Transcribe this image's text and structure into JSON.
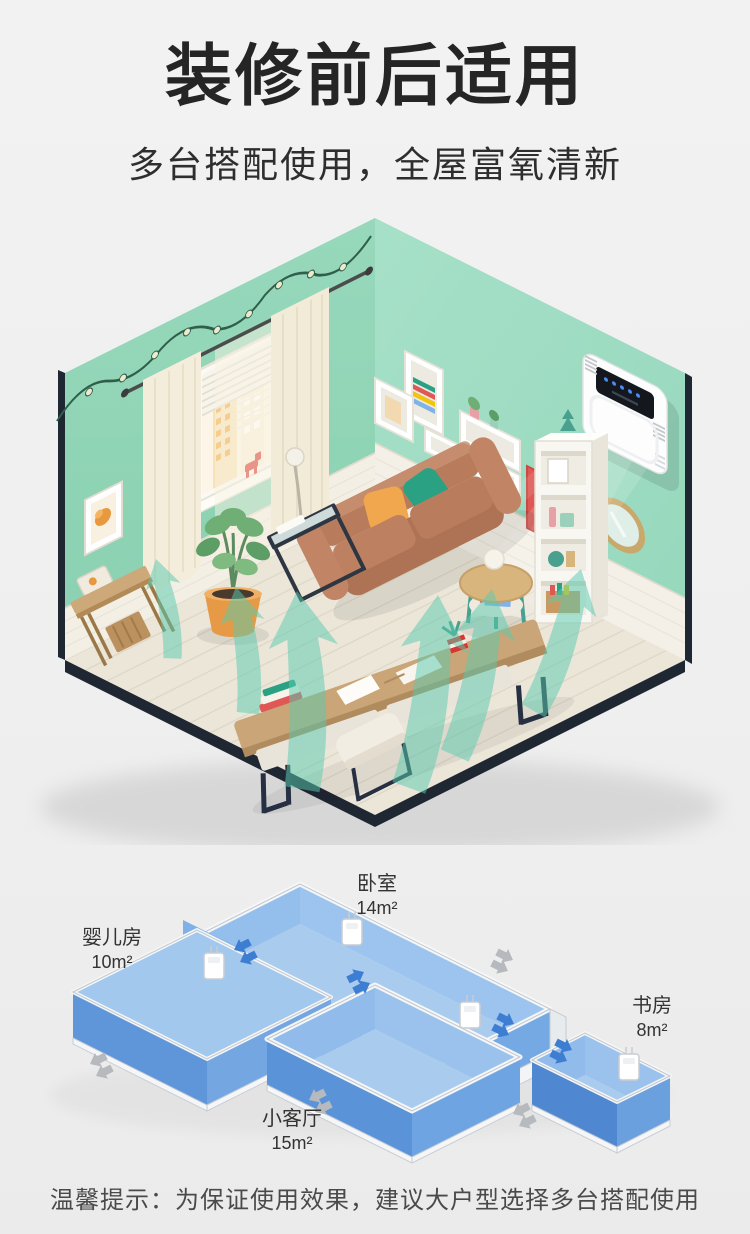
{
  "page": {
    "background": "#efefef",
    "title": "装修前后适用",
    "subtitle": "多台搭配使用，全屋富氧清新",
    "tip": "温馨提示：为保证使用效果，建议大户型选择多台搭配使用"
  },
  "scene": {
    "description": "isometric living room with wall-mounted fresh air purifier blowing fresh air",
    "colors": {
      "wall_left": "#8fd4b6",
      "wall_right": "#9cdcc2",
      "floor": "#ece6d9",
      "outer_edge": "#1f2733",
      "airflow": "#58cbb0",
      "sofa": "#b57d5e",
      "pillow_orange": "#f1a74e",
      "pillow_teal": "#2ba183",
      "curtain": "#f4eddb",
      "pot": "#e79a45"
    },
    "device": {
      "body_color": "#fdfdfe",
      "screen_color": "#14181e",
      "indicator_color": "#4a8cf0"
    }
  },
  "floorplan": {
    "rooms": [
      {
        "id": "baby",
        "name": "婴儿房",
        "area": "10m²"
      },
      {
        "id": "bedroom",
        "name": "卧室",
        "area": "14m²"
      },
      {
        "id": "study",
        "name": "书房",
        "area": "8m²"
      },
      {
        "id": "living",
        "name": "小客厅",
        "area": "15m²"
      }
    ],
    "device_count": 4,
    "colors": {
      "room_floor": "#a9cbee",
      "wall_light": "#9ac2ec",
      "wall_dark": "#5f96da",
      "rim": "#f4f6f8",
      "arrow_flow": "#3e7ed2",
      "arrow_exhaust": "#b6b9bd"
    }
  }
}
